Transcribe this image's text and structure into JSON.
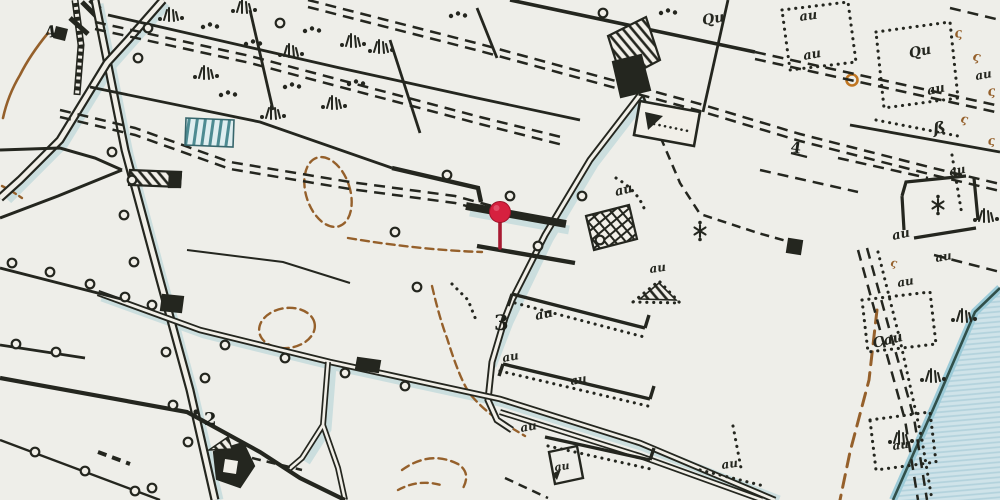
{
  "map": {
    "pin": {
      "x": 500,
      "y": 212,
      "head_color": "#d6213f",
      "stem_color": "#a81a32"
    },
    "parcel_numbers": {
      "n2": "2",
      "n3": "3",
      "n4": "4",
      "four_mark": "4"
    },
    "script_marks": {
      "au": "au",
      "qu": "Qu",
      "cau": "Cau",
      "eszett": "ß",
      "sigma": "ς"
    },
    "colors": {
      "paper": "#f1efe8",
      "ink": "#24261f",
      "brown": "#95602b",
      "water_fill": "#cfe3e9",
      "water_stripe": "#b2d2dc",
      "shore_band": "#9ccbd8",
      "teal_shadow": "#b5d4d8",
      "orange": "#c07622",
      "pin_red": "#d6213f"
    }
  }
}
